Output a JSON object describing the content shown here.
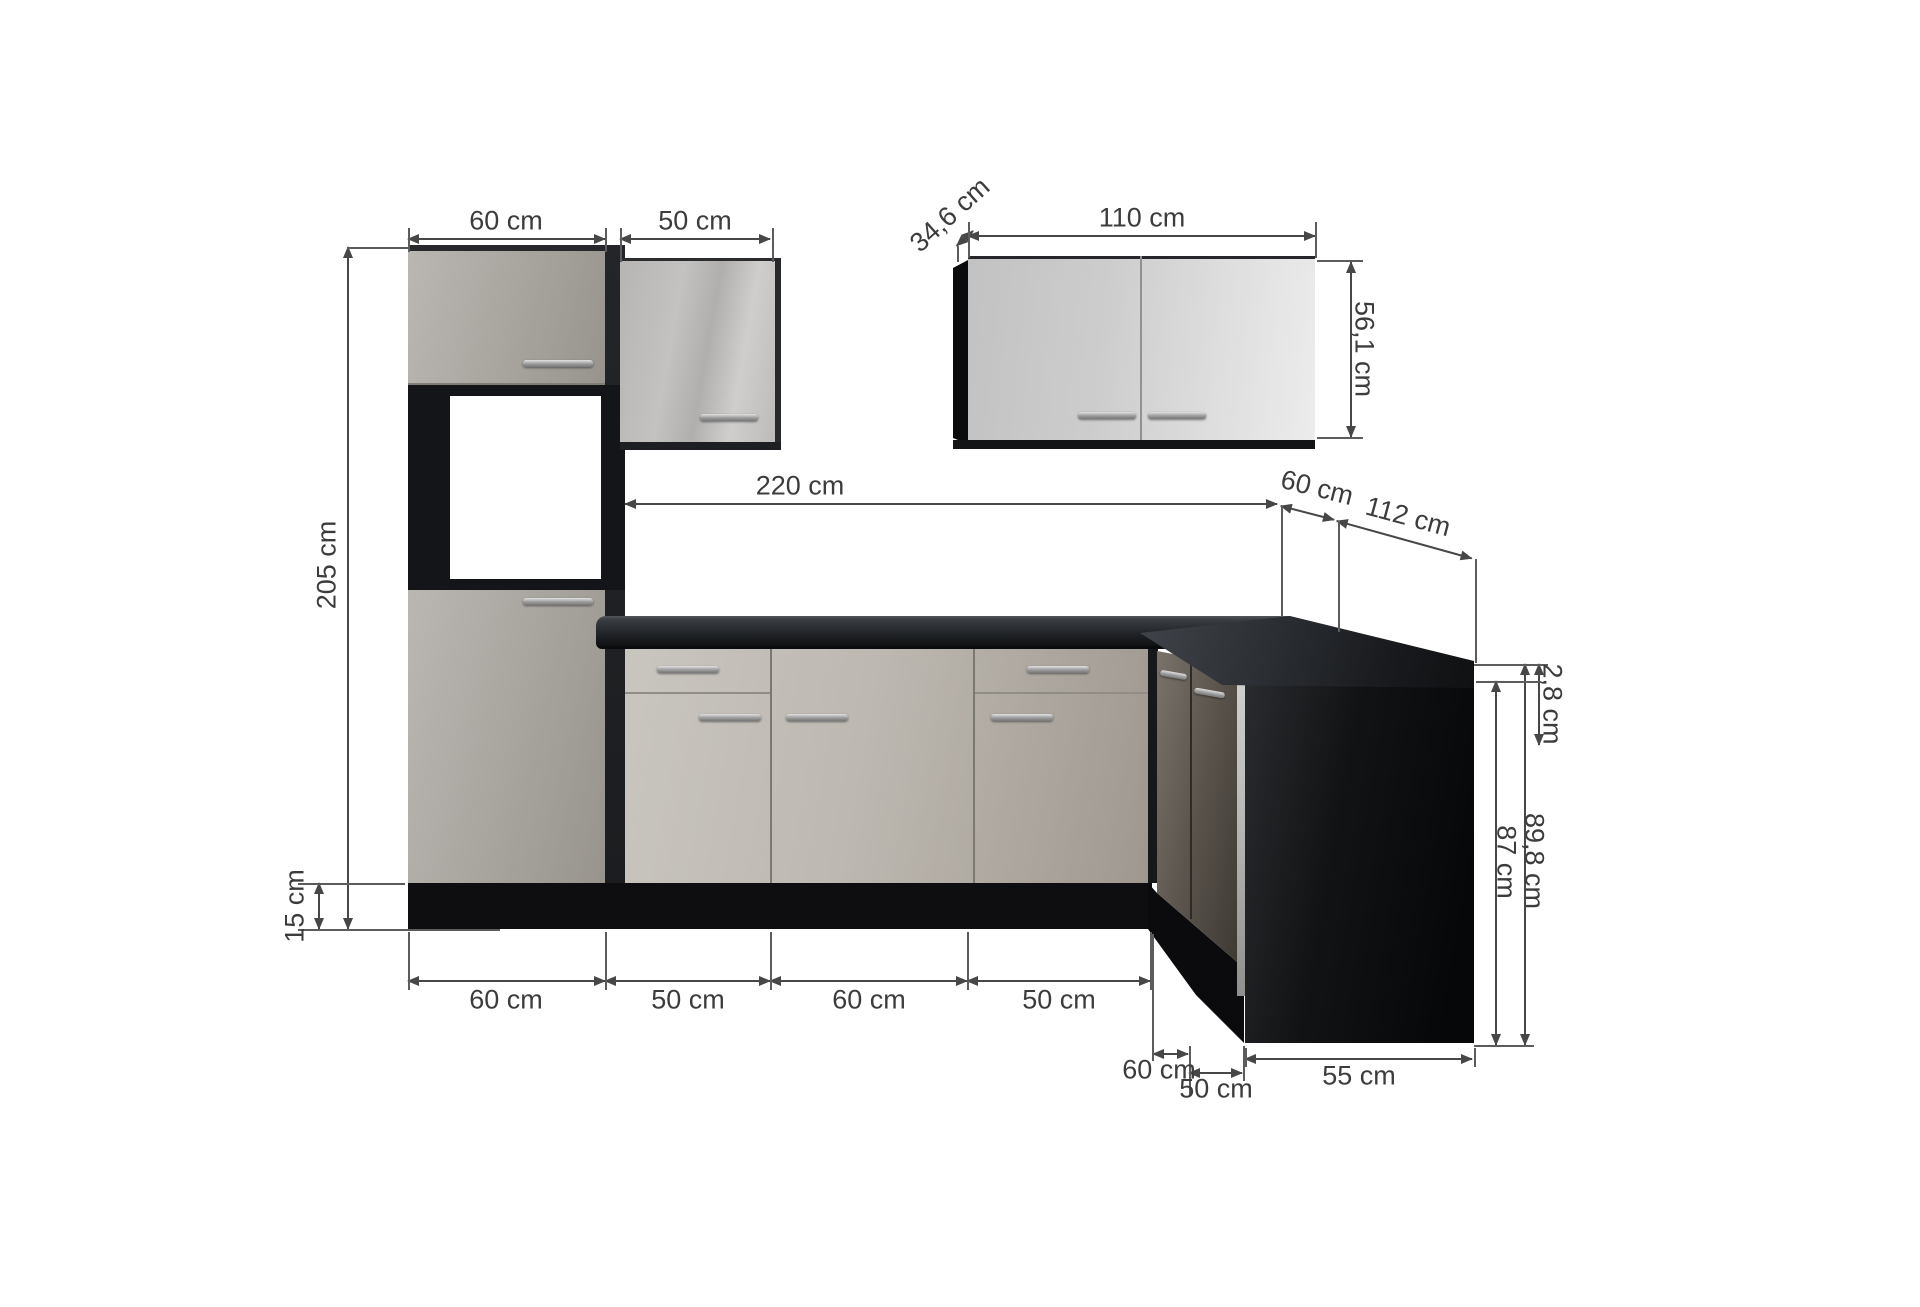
{
  "title": "L-shaped kitchen unit dimension diagram",
  "units": "cm",
  "colors": {
    "worktop_anthracite": "#26282c",
    "front_light_grey": "#b7b3ac",
    "front_gloss_grey": "#d9d9d9",
    "carcass_black": "#131416",
    "dimension_line": "#474747",
    "background": "#ffffff"
  },
  "dims": {
    "tall_width": "60 cm",
    "wall_small_width": "50 cm",
    "upper_depth": "34,6 cm",
    "upper_width": "110 cm",
    "upper_height": "56,1 cm",
    "total_height": "205 cm",
    "run_length": "220 cm",
    "corner_top": "60 cm",
    "return_length": "112 cm",
    "worktop_thickness": "2,8 cm",
    "base_height": "87 cm",
    "total_base_height": "89,8 cm",
    "plinth_height": "15 cm",
    "base_row": [
      "60 cm",
      "50 cm",
      "60 cm",
      "50 cm"
    ],
    "corner_width": "60 cm",
    "return_cab_width": "50 cm",
    "island_side": "55 cm"
  }
}
